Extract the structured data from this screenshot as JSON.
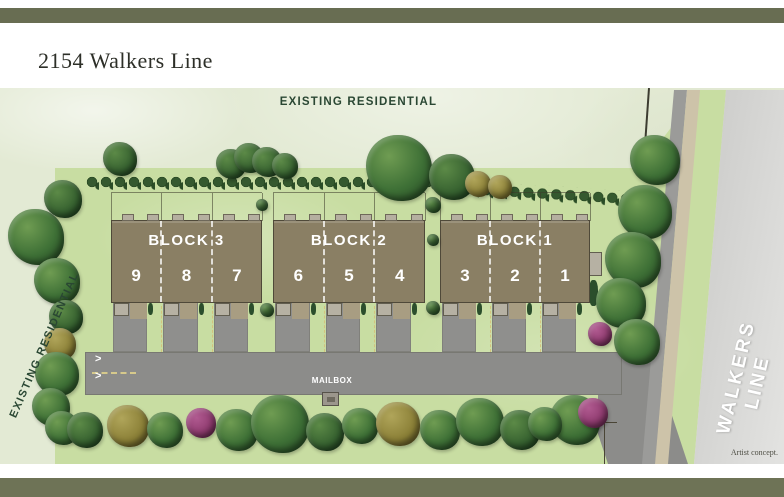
{
  "header": {
    "title": "2154 Walkers Line"
  },
  "labels": {
    "top": "EXISTING RESIDENTIAL",
    "left": "EXISTING RESIDENTIAL",
    "street": "WALKERS LINE",
    "mailbox": "MAILBOX",
    "artist_note": "Artist concept.",
    "road_arrow": ">"
  },
  "blocks": [
    {
      "name": "BLOCK 3",
      "units": [
        "9",
        "8",
        "7"
      ]
    },
    {
      "name": "BLOCK 2",
      "units": [
        "6",
        "5",
        "4"
      ]
    },
    {
      "name": "BLOCK 1",
      "units": [
        "3",
        "2",
        "1"
      ]
    }
  ],
  "colors": {
    "accent_olive_bar": "#686d52",
    "map_background": "#e3ead4",
    "property_grass": "#c8dda2",
    "building": "#8a7f64",
    "road": "#8c8c8a",
    "sidewalk": "#cdc3a9",
    "label_green": "#2a4733",
    "street_text": "#ffffff",
    "olive_tree": "#8a7f36",
    "purple_bush": "#8e3a6e"
  }
}
